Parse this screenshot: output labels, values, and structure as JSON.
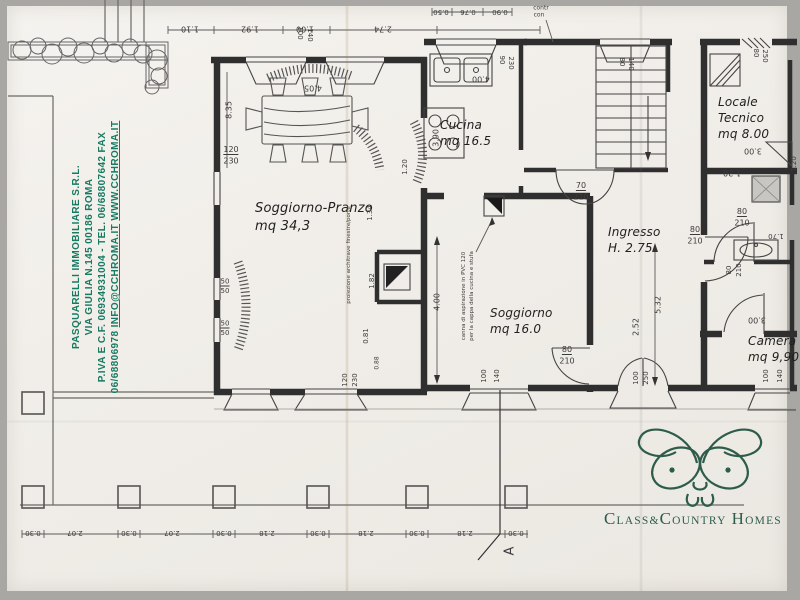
{
  "colors": {
    "paper": "#f0ede8",
    "ink": "#2f2f2f",
    "agency_green": "#177a63",
    "logo_green": "#2d5c4b"
  },
  "agency": {
    "line1": "Pasquarelli Immobiliare S.R.L.",
    "line2": "Via Giulia N.145 00186 Roma",
    "line3": "P.Iva e C.F. 06934931004 - Tel. 06/68807642 Fax",
    "line4_number": "06/68806978",
    "line4_email": "info@cchroma.it",
    "line4_web": "www.cchroma.it"
  },
  "logo": {
    "c1": "C",
    "r1": "lass",
    "amp": "&",
    "c2": "C",
    "r2": "ountry",
    "c3": "H",
    "r3": "omes"
  },
  "rooms": [
    {
      "name": "Soggiorno-Pranzo",
      "area": "mq 34,3"
    },
    {
      "name": "Cucina",
      "area": "mq 16.5"
    },
    {
      "name": "Soggiorno",
      "area": "mq 16.0"
    },
    {
      "name": "Ingresso",
      "area": "H. 2.75"
    },
    {
      "name": "Locale Tecnico",
      "area": "mq 8.00"
    },
    {
      "name": "Camera",
      "area": "mq 9,90"
    }
  ],
  "plan": {
    "section_marker": "A",
    "dimension_labels": [
      {
        "t": "1.10",
        "x": 190,
        "y": 29,
        "r": 180
      },
      {
        "t": "1.92",
        "x": 250,
        "y": 29,
        "r": 180
      },
      {
        "t": "1.00",
        "x": 305,
        "y": 29,
        "r": 180
      },
      {
        "t": "2.74",
        "x": 383,
        "y": 29,
        "r": 180
      },
      {
        "t": "0.50",
        "x": 441,
        "y": 12,
        "r": 180,
        "s": 7
      },
      {
        "t": "0.76",
        "x": 468,
        "y": 12,
        "r": 180,
        "s": 7
      },
      {
        "t": "0.90",
        "x": 500,
        "y": 12,
        "r": 180,
        "s": 7
      },
      {
        "t": "contr",
        "x": 541,
        "y": 8,
        "s": 6
      },
      {
        "t": "con",
        "x": 539,
        "y": 15,
        "s": 6
      },
      {
        "t": "100",
        "x": 300,
        "y": 33,
        "r": 90,
        "s": 7
      },
      {
        "t": "140",
        "x": 310,
        "y": 35,
        "r": 90,
        "s": 7
      },
      {
        "t": "90",
        "x": 502,
        "y": 60,
        "r": 90,
        "s": 7
      },
      {
        "t": "230",
        "x": 511,
        "y": 63,
        "r": 90,
        "s": 7
      },
      {
        "t": "80",
        "x": 622,
        "y": 62,
        "r": 90,
        "s": 7
      },
      {
        "t": "140",
        "x": 631,
        "y": 64,
        "r": 90,
        "s": 7
      },
      {
        "t": "80",
        "x": 756,
        "y": 53,
        "r": 90,
        "s": 7
      },
      {
        "t": "250",
        "x": 765,
        "y": 56,
        "r": 90,
        "s": 7
      },
      {
        "t": "120",
        "x": 231,
        "y": 150,
        "u": 1
      },
      {
        "t": "230",
        "x": 231,
        "y": 161
      },
      {
        "t": "8.35",
        "x": 229,
        "y": 110,
        "r": -90
      },
      {
        "t": "4.05",
        "x": 313,
        "y": 88,
        "r": 180
      },
      {
        "t": "50",
        "x": 225,
        "y": 282,
        "s": 7,
        "u": 1
      },
      {
        "t": "50",
        "x": 225,
        "y": 291,
        "s": 7
      },
      {
        "t": "50",
        "x": 225,
        "y": 324,
        "s": 7,
        "u": 1
      },
      {
        "t": "50",
        "x": 225,
        "y": 333,
        "s": 7
      },
      {
        "t": "3.90",
        "x": 436,
        "y": 138,
        "r": -90
      },
      {
        "t": "4.00",
        "x": 481,
        "y": 79,
        "r": 180
      },
      {
        "t": "1.20",
        "x": 405,
        "y": 167,
        "r": -90,
        "s": 7
      },
      {
        "t": "1.34",
        "x": 370,
        "y": 213,
        "r": -90,
        "s": 7
      },
      {
        "t": "1.82",
        "x": 372,
        "y": 281,
        "r": -90,
        "s": 7
      },
      {
        "t": "0.81",
        "x": 366,
        "y": 336,
        "r": -90,
        "s": 7
      },
      {
        "t": "4.00",
        "x": 437,
        "y": 302,
        "r": -90
      },
      {
        "t": "70",
        "x": 581,
        "y": 186,
        "u": 1
      },
      {
        "t": "210",
        "x": 581,
        "y": 197
      },
      {
        "t": "5.32",
        "x": 658,
        "y": 305,
        "r": -90
      },
      {
        "t": "2.52",
        "x": 636,
        "y": 327,
        "r": -90
      },
      {
        "t": "80",
        "x": 695,
        "y": 230,
        "u": 1
      },
      {
        "t": "210",
        "x": 695,
        "y": 241
      },
      {
        "t": "80",
        "x": 742,
        "y": 212,
        "u": 1
      },
      {
        "t": "210",
        "x": 742,
        "y": 223
      },
      {
        "t": "1.70",
        "x": 776,
        "y": 236,
        "r": 180,
        "s": 7
      },
      {
        "t": "80",
        "x": 729,
        "y": 270,
        "r": -90,
        "s": 7
      },
      {
        "t": "210",
        "x": 739,
        "y": 270,
        "r": -90,
        "s": 7
      },
      {
        "t": "80",
        "x": 567,
        "y": 350,
        "u": 1
      },
      {
        "t": "210",
        "x": 567,
        "y": 361
      },
      {
        "t": "120",
        "x": 345,
        "y": 380,
        "r": -90,
        "s": 7
      },
      {
        "t": "230",
        "x": 355,
        "y": 380,
        "r": -90,
        "s": 7
      },
      {
        "t": "0.88",
        "x": 377,
        "y": 363,
        "r": -90,
        "s": 6
      },
      {
        "t": "100",
        "x": 484,
        "y": 376,
        "r": -90,
        "s": 7
      },
      {
        "t": "140",
        "x": 497,
        "y": 376,
        "r": -90,
        "s": 7
      },
      {
        "t": "100",
        "x": 636,
        "y": 378,
        "r": -90,
        "s": 7
      },
      {
        "t": "250",
        "x": 646,
        "y": 378,
        "r": -90,
        "s": 7
      },
      {
        "t": "100",
        "x": 766,
        "y": 376,
        "r": -90,
        "s": 7
      },
      {
        "t": "140",
        "x": 780,
        "y": 376,
        "r": -90,
        "s": 7
      },
      {
        "t": "3.00",
        "x": 757,
        "y": 320,
        "r": 180
      },
      {
        "t": "3.00",
        "x": 753,
        "y": 151,
        "r": 180
      },
      {
        "t": "1.20",
        "x": 732,
        "y": 173,
        "r": 180
      },
      {
        "t": "1.20",
        "x": 794,
        "y": 164,
        "r": -90,
        "s": 7
      },
      {
        "t": "0.30",
        "x": 33,
        "y": 533,
        "r": 180,
        "s": 7
      },
      {
        "t": "2.07",
        "x": 75,
        "y": 533,
        "r": 180,
        "s": 7
      },
      {
        "t": "0.30",
        "x": 129,
        "y": 533,
        "r": 180,
        "s": 7
      },
      {
        "t": "2.07",
        "x": 172,
        "y": 533,
        "r": 180,
        "s": 7
      },
      {
        "t": "0.30",
        "x": 224,
        "y": 533,
        "r": 180,
        "s": 7
      },
      {
        "t": "2.18",
        "x": 267,
        "y": 533,
        "r": 180,
        "s": 7
      },
      {
        "t": "0.30",
        "x": 318,
        "y": 533,
        "r": 180,
        "s": 7
      },
      {
        "t": "2.18",
        "x": 366,
        "y": 533,
        "r": 180,
        "s": 7
      },
      {
        "t": "0.30",
        "x": 417,
        "y": 533,
        "r": 180,
        "s": 7
      },
      {
        "t": "2.18",
        "x": 465,
        "y": 533,
        "r": 180,
        "s": 7
      },
      {
        "t": "0.30",
        "x": 516,
        "y": 533,
        "r": 180,
        "s": 7
      },
      {
        "t": "A",
        "x": 510,
        "y": 551,
        "r": -90,
        "s": 13
      },
      {
        "t": "proiezione architrave finestre/porte",
        "x": 349,
        "y": 255,
        "r": -90,
        "s": 5.5
      },
      {
        "t": "canna di aspirazione in PVC 120",
        "x": 464,
        "y": 296,
        "r": -90,
        "s": 5.5
      },
      {
        "t": "per la cappa della cucina e stufa",
        "x": 472,
        "y": 296,
        "r": -90,
        "s": 5.5
      }
    ]
  }
}
